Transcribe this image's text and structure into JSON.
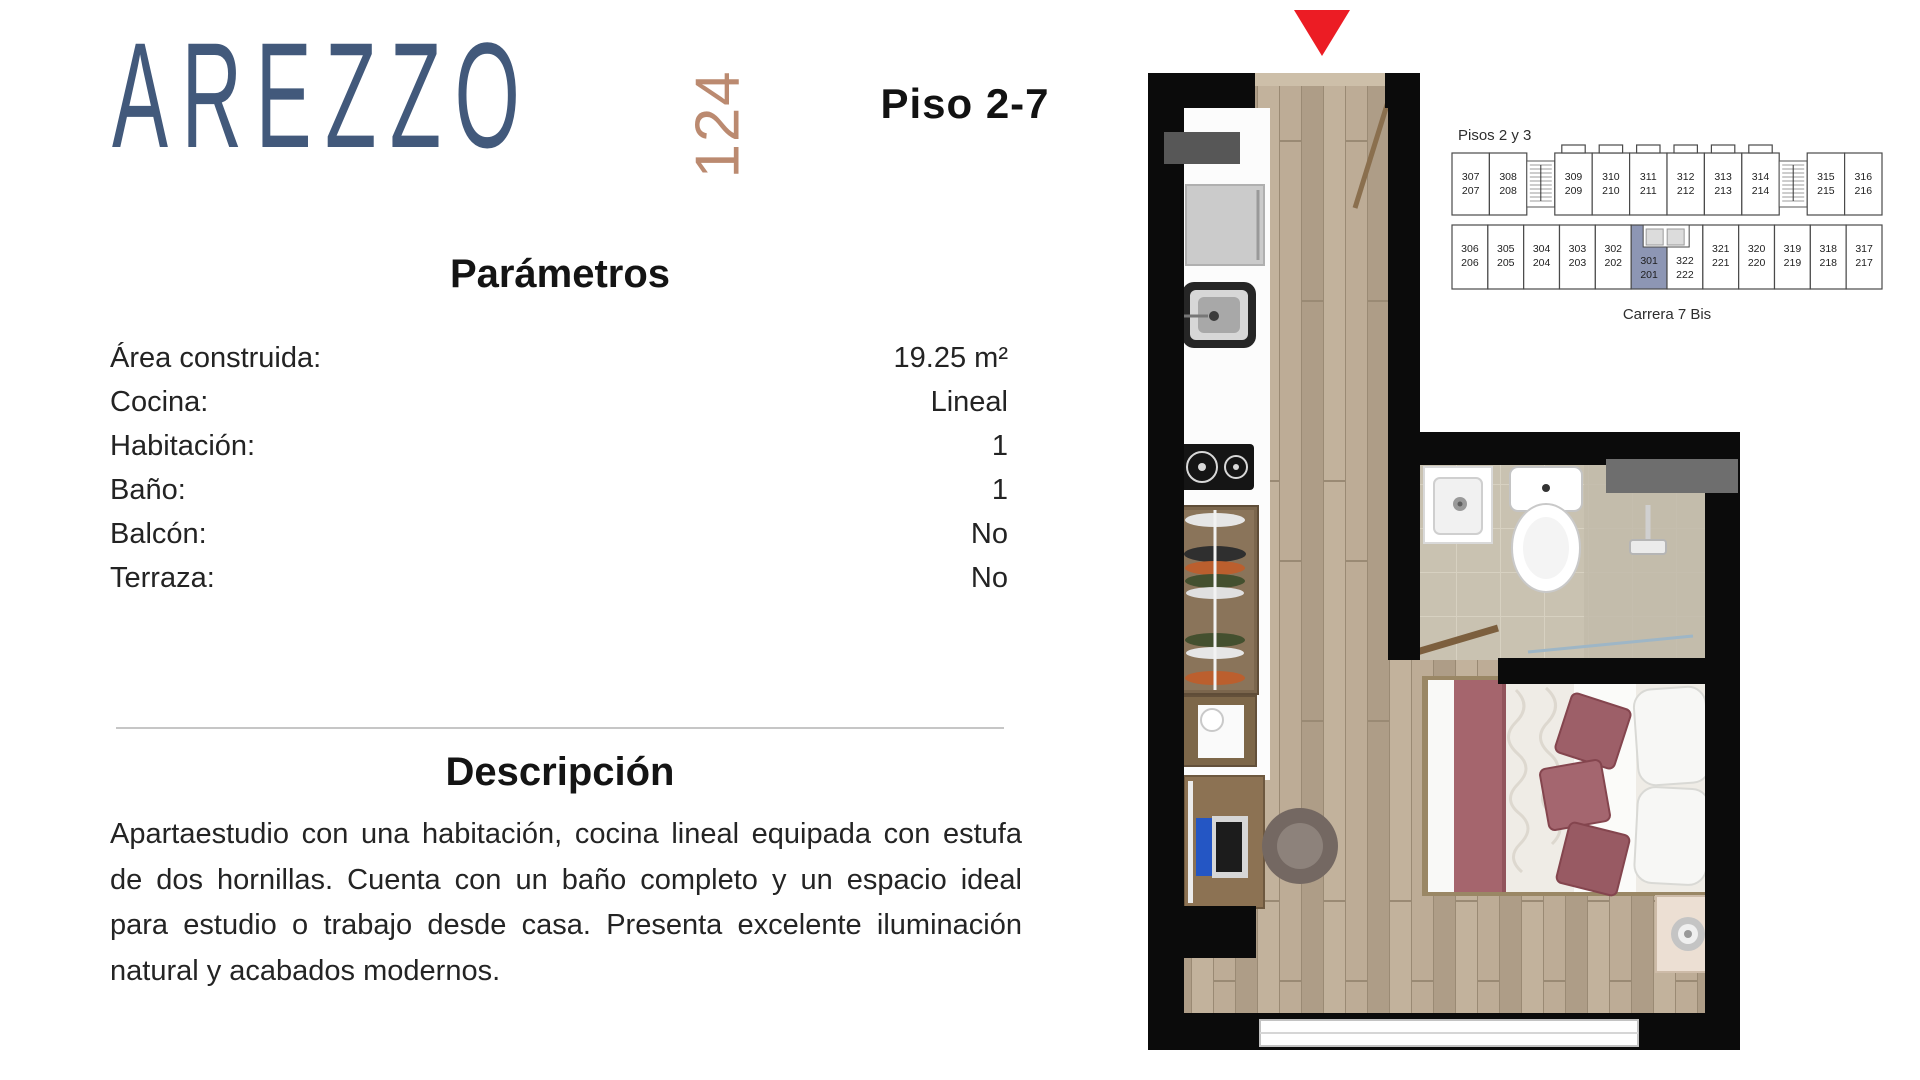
{
  "colors": {
    "logo_navy": "#42597b",
    "logo_terracotta": "#bb8a70",
    "marker_red": "#ec1c24",
    "keyplan_highlight": "#8d96b4",
    "divider_gray": "#c6c6c6"
  },
  "brand": {
    "name": "AREZZO",
    "number": "124"
  },
  "floor_heading": "Piso 2-7",
  "parameters": {
    "title": "Parámetros",
    "rows": [
      {
        "label": "Área construida:",
        "value": "19.25 m²"
      },
      {
        "label": "Cocina:",
        "value": "Lineal"
      },
      {
        "label": "Habitación:",
        "value": "1"
      },
      {
        "label": "Baño:",
        "value": "1"
      },
      {
        "label": "Balcón:",
        "value": "No"
      },
      {
        "label": "Terraza:",
        "value": "No"
      }
    ]
  },
  "description": {
    "title": "Descripción",
    "body": "Apartaestudio con una habitación, cocina lineal equipada con estufa de dos hornillas. Cuenta con un baño completo y un espacio ideal para estudio o trabajo desde casa. Presenta excelente iluminación natural y acabados modernos."
  },
  "keyplan": {
    "title": "Pisos 2 y 3",
    "street_label": "Carrera 7 Bis",
    "top_row": [
      {
        "type": "unit",
        "lines": [
          "307",
          "207"
        ]
      },
      {
        "type": "unit",
        "lines": [
          "308",
          "208"
        ]
      },
      {
        "type": "stairs"
      },
      {
        "type": "unit",
        "lines": [
          "309",
          "209"
        ],
        "notch": true
      },
      {
        "type": "unit",
        "lines": [
          "310",
          "210"
        ],
        "notch": true
      },
      {
        "type": "unit",
        "lines": [
          "311",
          "211"
        ],
        "notch": true
      },
      {
        "type": "unit",
        "lines": [
          "312",
          "212"
        ],
        "notch": true
      },
      {
        "type": "unit",
        "lines": [
          "313",
          "213"
        ],
        "notch": true
      },
      {
        "type": "unit",
        "lines": [
          "314",
          "214"
        ],
        "notch": true
      },
      {
        "type": "stairs"
      },
      {
        "type": "unit",
        "lines": [
          "315",
          "215"
        ]
      },
      {
        "type": "unit",
        "lines": [
          "316",
          "216"
        ]
      }
    ],
    "bottom_row": [
      {
        "lines": [
          "306",
          "206"
        ]
      },
      {
        "lines": [
          "305",
          "205"
        ]
      },
      {
        "lines": [
          "304",
          "204"
        ]
      },
      {
        "lines": [
          "303",
          "203"
        ]
      },
      {
        "lines": [
          "302",
          "202"
        ]
      },
      {
        "lines": [
          "301",
          "201"
        ],
        "highlight": true,
        "text_low": true
      },
      {
        "lines": [
          "322",
          "222"
        ],
        "text_low": true
      },
      {
        "lines": [
          "321",
          "221"
        ]
      },
      {
        "lines": [
          "320",
          "220"
        ]
      },
      {
        "lines": [
          "319",
          "219"
        ]
      },
      {
        "lines": [
          "318",
          "218"
        ]
      },
      {
        "lines": [
          "317",
          "217"
        ]
      }
    ]
  }
}
